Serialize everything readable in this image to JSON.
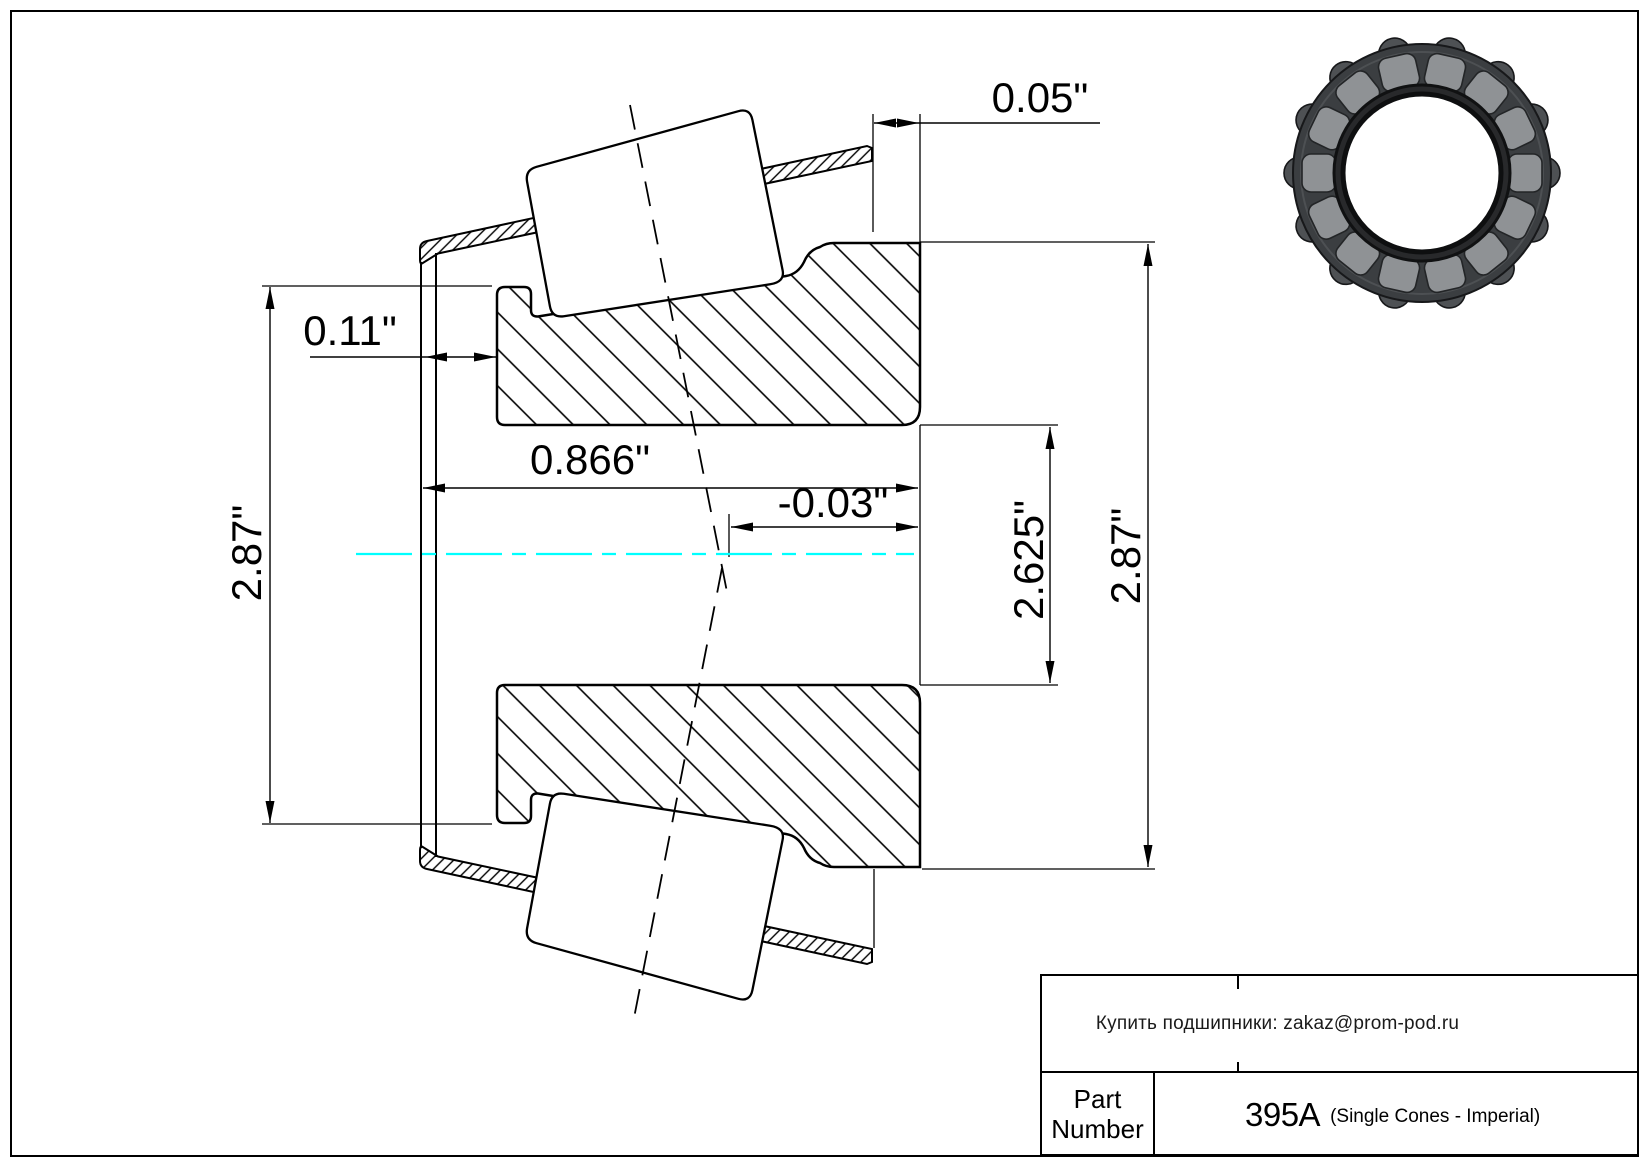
{
  "drawing": {
    "dimensions": {
      "cage_overhang": "0.05\"",
      "front_offset": "0.11\"",
      "cone_width": "0.866\"",
      "effective_center": "-0.03\"",
      "bore_diameter": "2.625\"",
      "left_diameter": "2.87\"",
      "right_diameter": "2.87\""
    },
    "centerline_color": "#00ffff"
  },
  "title_block": {
    "contact_line": "Купить подшипники: zakaz@prom-pod.ru",
    "part_label": {
      "line1": "Part",
      "line2": "Number"
    },
    "part_number": "395A",
    "part_series": "(Single Cones - Imperial)"
  }
}
